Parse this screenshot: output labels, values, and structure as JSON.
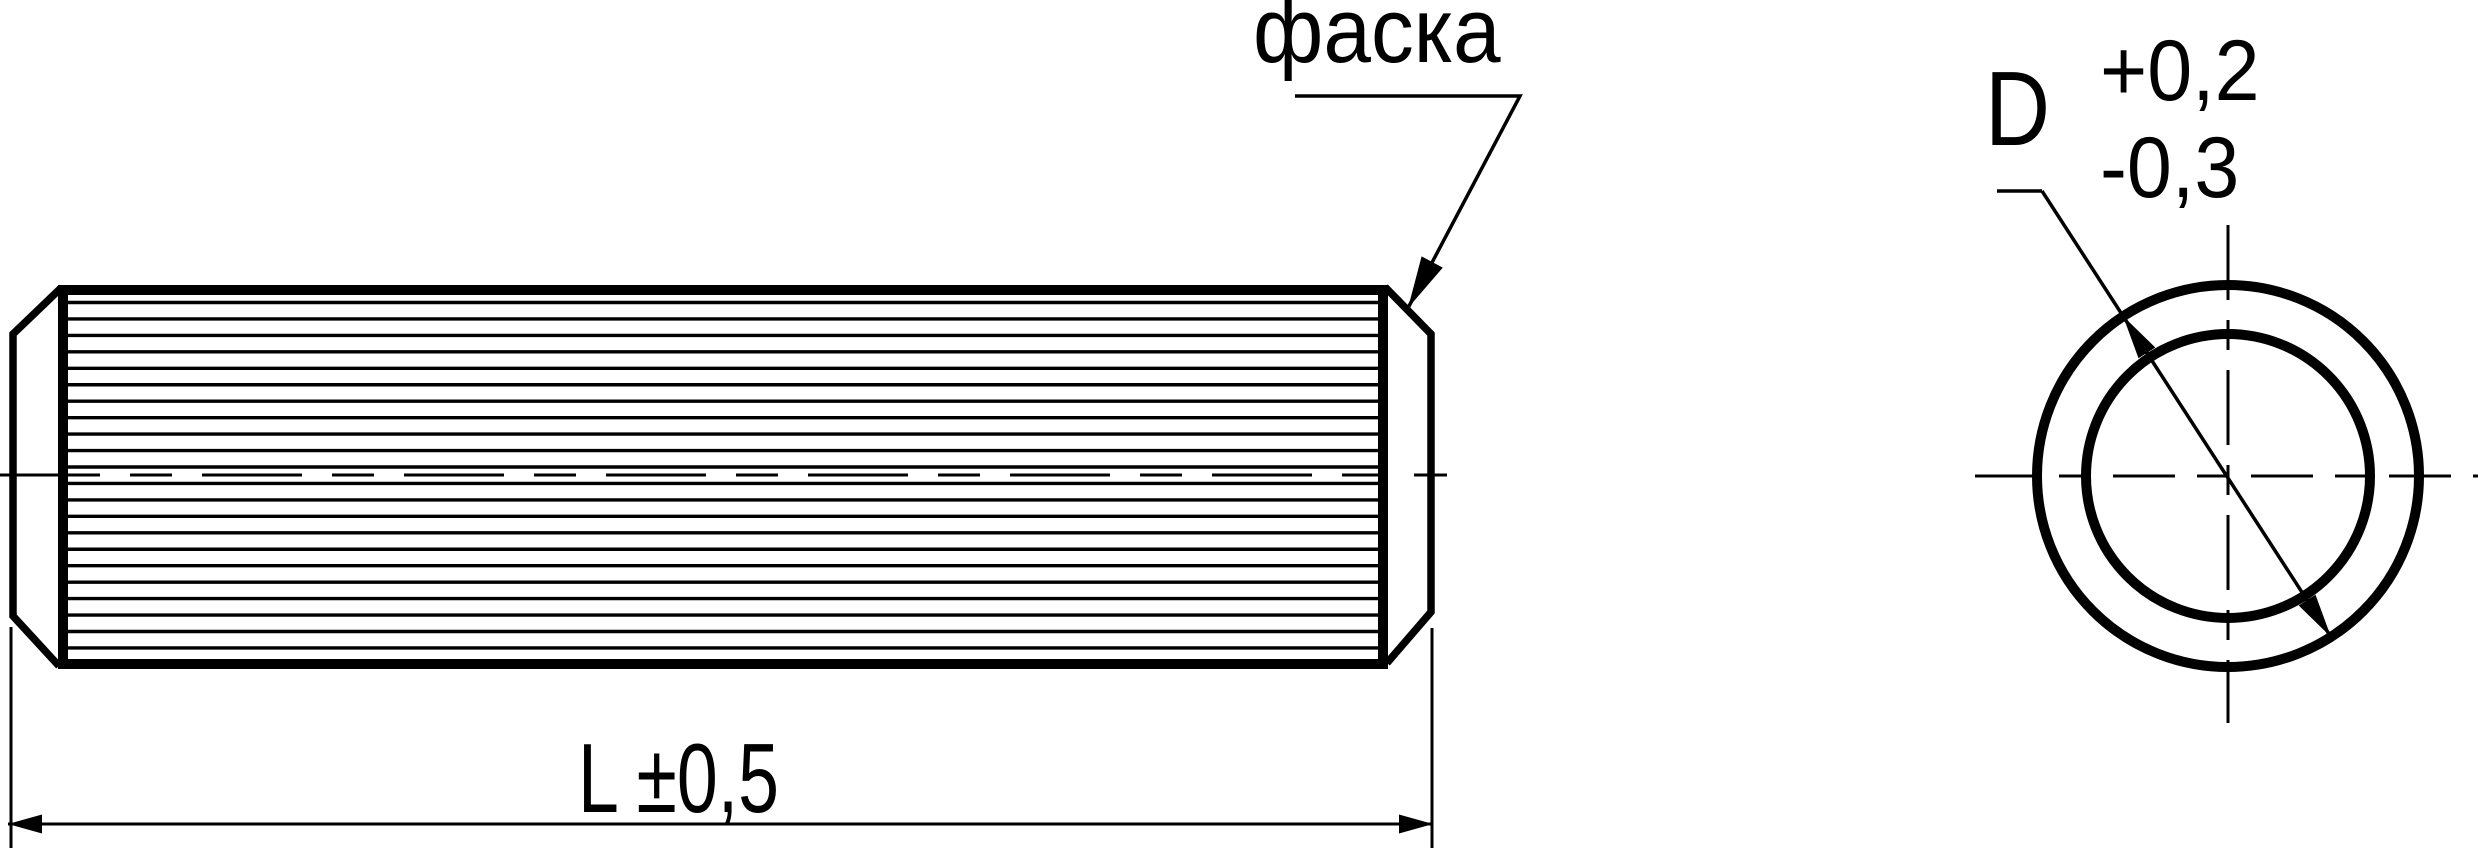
{
  "drawing": {
    "labels": {
      "chamfer": "фаска",
      "length_dimension": "L ±0,5",
      "diameter_letter": "D",
      "diameter_tolerance_upper": "+0,2",
      "diameter_tolerance_lower": "-0,3"
    },
    "colors": {
      "line": "#000000",
      "background": "#ffffff"
    }
  }
}
